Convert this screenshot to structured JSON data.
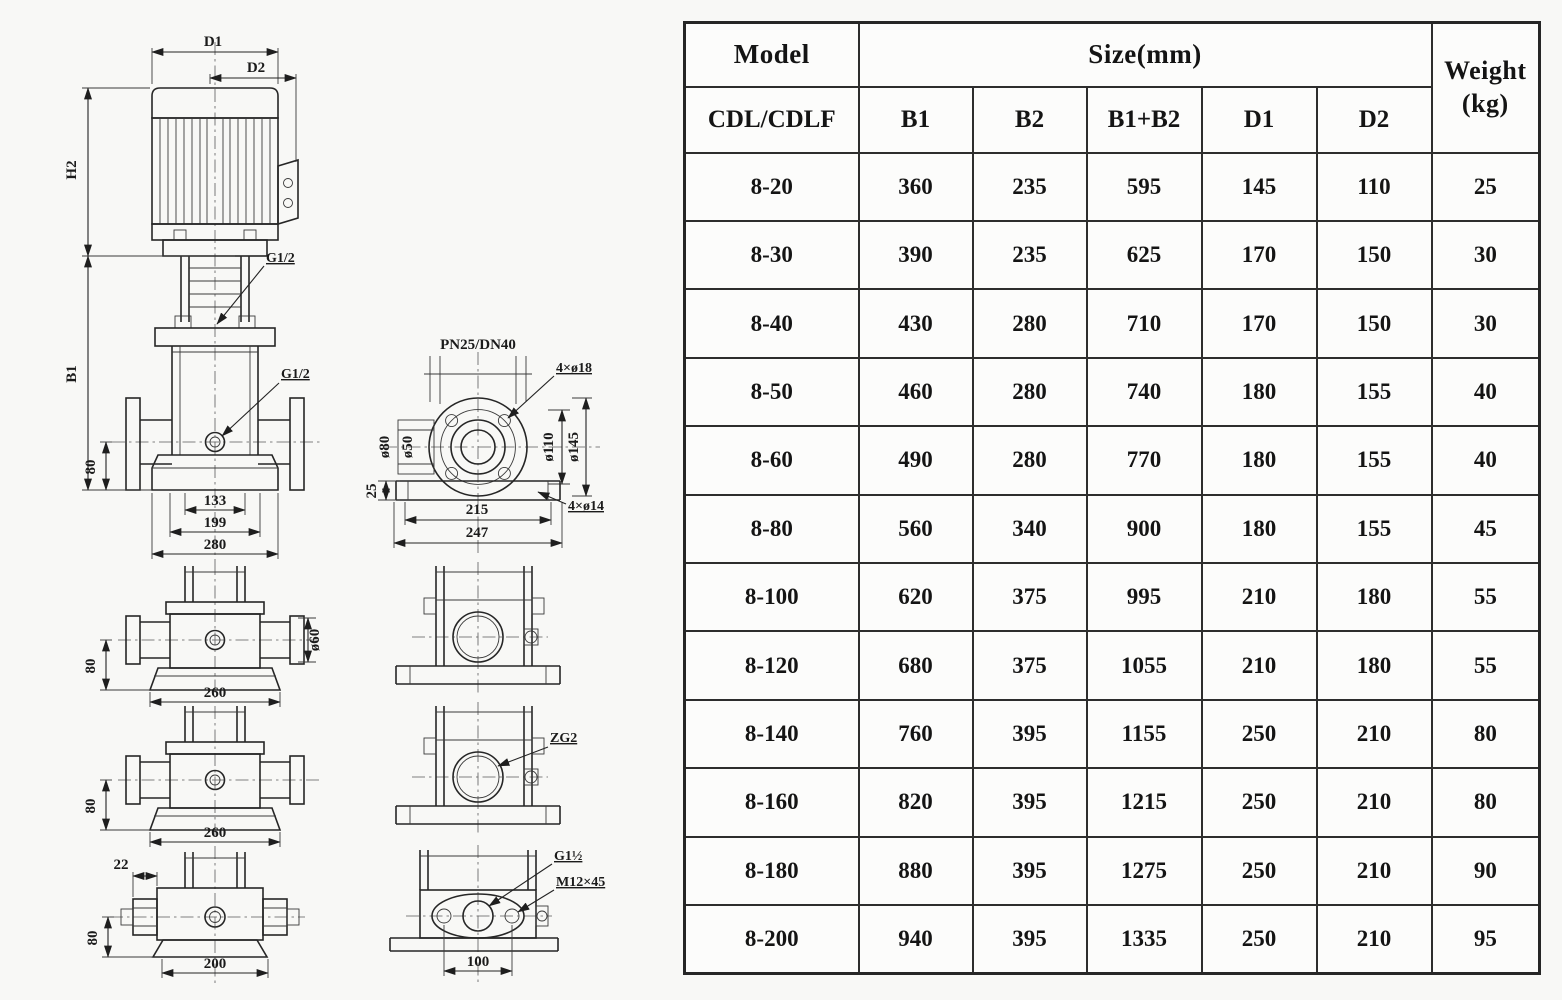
{
  "colors": {
    "paper": "#f8f8f6",
    "ink": "#1b1b1b",
    "table_border": "#2d2d2d",
    "cell_background": "#fcfcfb"
  },
  "drawing": {
    "front_view": {
      "d1": "D1",
      "d2": "D2",
      "h2": "H2",
      "b1": "B1",
      "g12_top": "G1/2",
      "g12_mid": "G1/2",
      "h80": "80",
      "w133": "133",
      "w199": "199",
      "w280": "280"
    },
    "flange_view": {
      "title": "PN25/DN40",
      "bolt_holes": "4×ø18",
      "d80": "ø80",
      "d50": "ø50",
      "d110": "ø110",
      "d145": "ø145",
      "h25": "25",
      "w215": "215",
      "w247": "247",
      "base_holes": "4×ø14"
    },
    "side_view_a": {
      "h80": "80",
      "w260": "260",
      "d60": "ø60"
    },
    "side_view_b": {
      "h80": "80",
      "w260": "260"
    },
    "side_view_c": {
      "w22": "22",
      "h80": "80",
      "w200": "200"
    },
    "port_view_b": {
      "zg2": "ZG2"
    },
    "port_view_c": {
      "g1half": "G1½",
      "m12": "M12×45",
      "w100": "100"
    }
  },
  "table": {
    "header": {
      "model": "Model",
      "size": "Size(mm)",
      "weight1": "Weight",
      "weight2": "(kg)"
    },
    "subheader": {
      "model": "CDL/CDLF",
      "b1": "B1",
      "b2": "B2",
      "b1b2": "B1+B2",
      "d1": "D1",
      "d2": "D2"
    },
    "rows": [
      [
        "8-20",
        "360",
        "235",
        "595",
        "145",
        "110",
        "25"
      ],
      [
        "8-30",
        "390",
        "235",
        "625",
        "170",
        "150",
        "30"
      ],
      [
        "8-40",
        "430",
        "280",
        "710",
        "170",
        "150",
        "30"
      ],
      [
        "8-50",
        "460",
        "280",
        "740",
        "180",
        "155",
        "40"
      ],
      [
        "8-60",
        "490",
        "280",
        "770",
        "180",
        "155",
        "40"
      ],
      [
        "8-80",
        "560",
        "340",
        "900",
        "180",
        "155",
        "45"
      ],
      [
        "8-100",
        "620",
        "375",
        "995",
        "210",
        "180",
        "55"
      ],
      [
        "8-120",
        "680",
        "375",
        "1055",
        "210",
        "180",
        "55"
      ],
      [
        "8-140",
        "760",
        "395",
        "1155",
        "250",
        "210",
        "80"
      ],
      [
        "8-160",
        "820",
        "395",
        "1215",
        "250",
        "210",
        "80"
      ],
      [
        "8-180",
        "880",
        "395",
        "1275",
        "250",
        "210",
        "90"
      ],
      [
        "8-200",
        "940",
        "395",
        "1335",
        "250",
        "210",
        "95"
      ]
    ]
  }
}
